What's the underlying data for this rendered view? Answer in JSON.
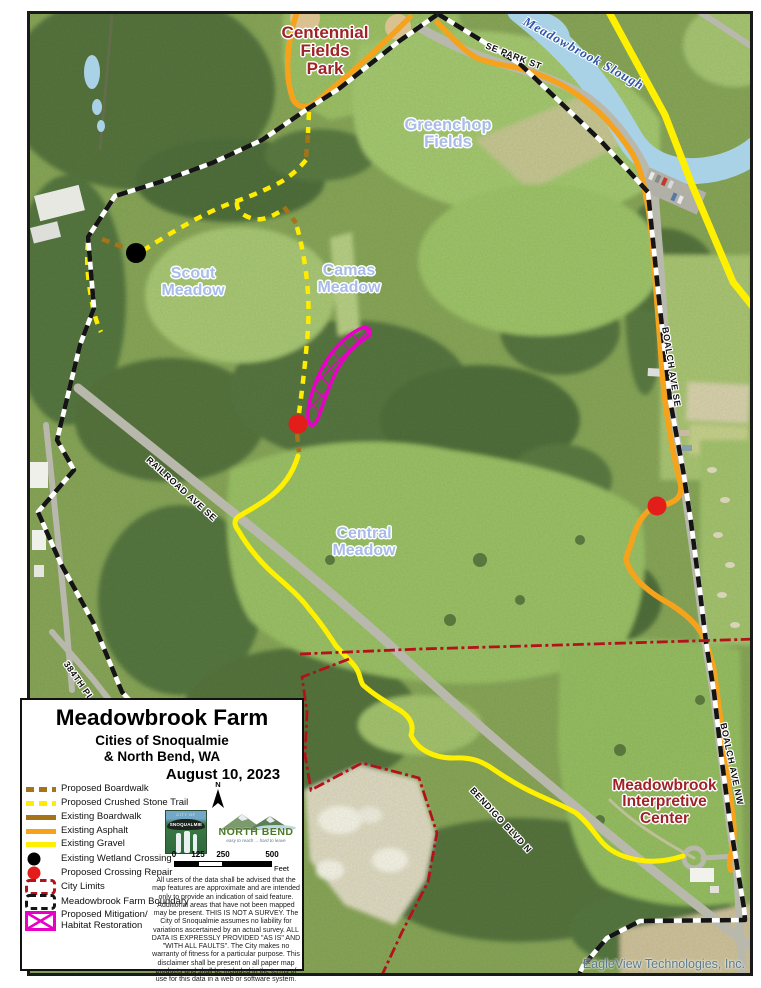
{
  "map": {
    "labels": {
      "centennial_park": "Centennial\nFields\nPark",
      "greenchop_fields": "Greenchop\nFields",
      "scout_meadow": "Scout\nMeadow",
      "camas_meadow": "Camas\nMeadow",
      "central_meadow": "Central\nMeadow",
      "interpretive_center": "Meadowbrook\nInterpretive\nCenter",
      "slough": "Meadowbrook Slough",
      "se_park_st": "SE PARK ST",
      "boalch_ave_se": "BOALCH AVE SE",
      "boalch_ave_nw": "BOALCH AVE NW",
      "railroad_ave_se": "RAILROAD AVE SE",
      "bendigo_blvd_n": "BENDIGO BLVD N",
      "street_384th": "384TH PL",
      "credit": "EagleView Technologies, Inc."
    },
    "colors": {
      "existing_asphalt": "#f7a21b",
      "existing_gravel": "#fff000",
      "proposed_crushed_stone": "#ffec00",
      "boardwalk_brown": "#a5731a",
      "city_limits_red": "#b3121b",
      "farm_boundary_black": "#141414",
      "mitigation_magenta": "#e800c6",
      "wetland_crossing_black": "#000000",
      "crossing_repair_red": "#e21d1a",
      "place_label_red": "#9f2227",
      "meadow_label_blue": "#a7bce8",
      "water_label_blue": "#2c55aa",
      "water": "#a9d2e6",
      "credit_gray": "#5d7b8c"
    }
  },
  "legend": {
    "title": "Meadowbrook Farm",
    "subtitle": "Cities of Snoqualmie\n& North Bend, WA",
    "date": "August 10, 2023",
    "north_label": "N",
    "items": [
      {
        "label": "Proposed Boardwalk",
        "color": "#a5731a"
      },
      {
        "label": "Proposed Crushed Stone Trail",
        "color": "#ffec00"
      },
      {
        "label": "Existing Boardwalk",
        "color": "#a5731a"
      },
      {
        "label": "Existing Asphalt",
        "color": "#f7a21b"
      },
      {
        "label": "Existing Gravel",
        "color": "#fff000"
      },
      {
        "label": "Existing Wetland Crossing",
        "color": "#000000"
      },
      {
        "label": "Proposed Crossing Repair",
        "color": "#e21d1a"
      },
      {
        "label": "City Limits",
        "color": "#b3121b"
      },
      {
        "label": "Meadowbrook Farm Boundary",
        "color": "#141414"
      },
      {
        "label": "Proposed Mitigation/\nHabitat Restoration",
        "color": "#e800c6"
      }
    ],
    "logos": {
      "snoqualmie_top": "CITY OF",
      "snoqualmie": "SNOQUALMIE",
      "north_bend": "NORTH BEND",
      "north_bend_tagline": "easy to reach ... hard to leave"
    },
    "scale": {
      "t0": "0",
      "t1": "125",
      "t2": "250",
      "t3": "500",
      "unit": "Feet"
    },
    "disclaimer": "All users of the data shall be advised that the map features are approximate and are intended only to provide an indication of said feature. Additional areas that have not been mapped may be present. THIS IS NOT A SURVEY. The City of Snoqualmie assumes no liability for variations ascertained by an actual survey. ALL DATA IS EXPRESSLY PROVIDED \"AS IS\" AND \"WITH ALL FAULTS\". The City makes no warranty of fitness for a particular purpose. This disclaimer shall be present on all paper map products and shall be included in the terms of use for this data in a web or software system."
  }
}
